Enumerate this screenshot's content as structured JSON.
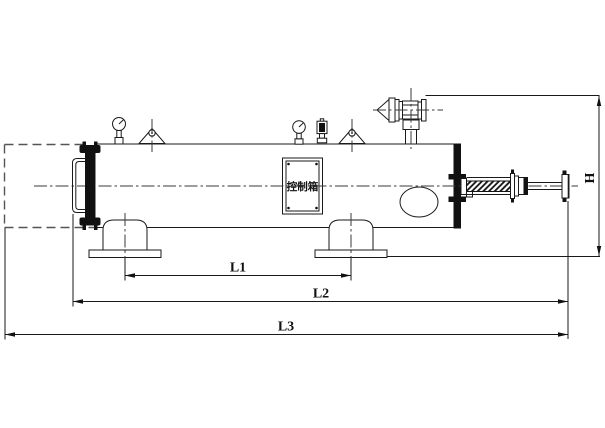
{
  "drawing": {
    "type": "engineering-outline-drawing",
    "labels": {
      "control_box": "控制箱",
      "dim_l1": "L1",
      "dim_l2": "L2",
      "dim_l3": "L3",
      "dim_h": "H"
    },
    "colors": {
      "background": "#ffffff",
      "line": "#1a1a1a",
      "centerline": "#3a3a3a",
      "phantom": "#555555"
    }
  }
}
